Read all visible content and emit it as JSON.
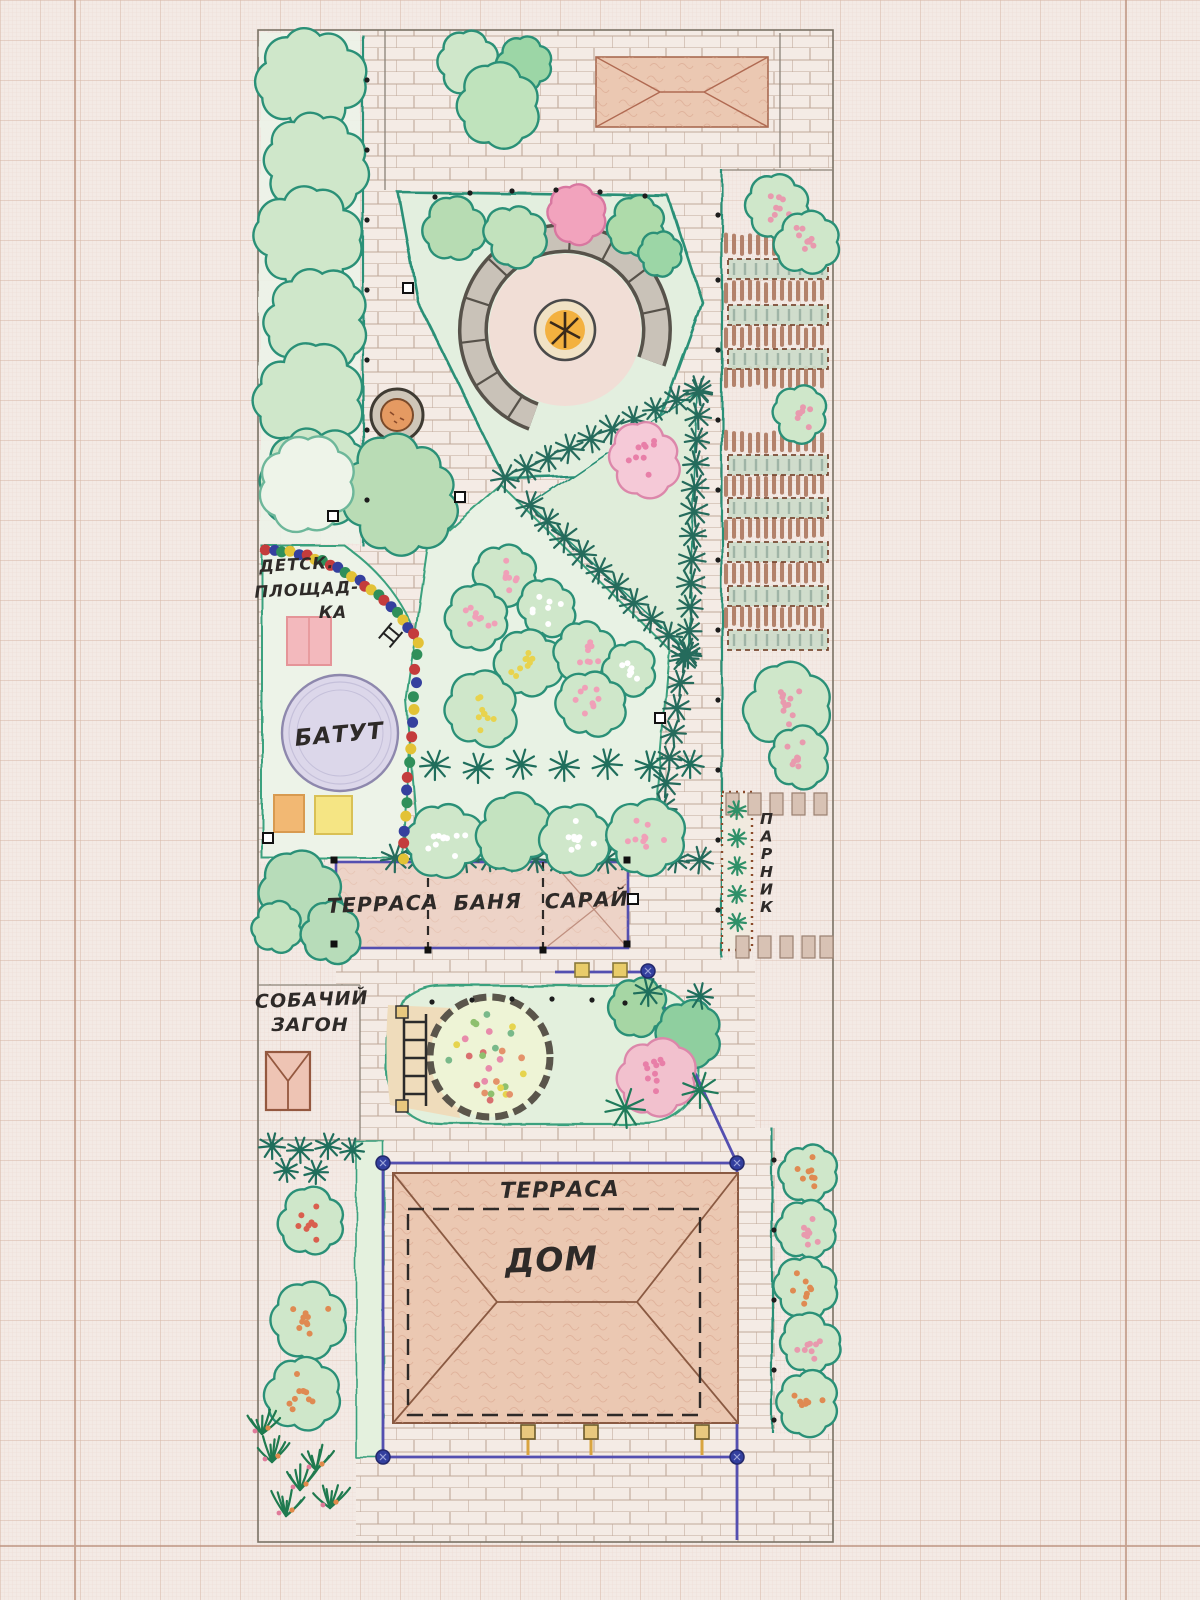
{
  "title": "Hand-drawn garden plot plan on millimeter graph paper",
  "labels": {
    "playground": [
      "ДЕТСК.",
      "ПЛОЩАД-",
      "КА"
    ],
    "trampoline": "БАТУТ",
    "terrace": "ТЕРРАСА",
    "banya": "БАНЯ",
    "shed": "САРАЙ",
    "dog_pen": [
      "СОБАЧИЙ",
      "ЗАГОН"
    ],
    "greenhouse": "ПАРНИК",
    "house_terrace": "ТЕРРАСА",
    "house": "ДОМ"
  },
  "colors": {
    "paper": "#f3eae5",
    "grid_fine": "#ecd8d1",
    "grid_major": "#d6b4a4",
    "brick_line": "#b69c8c",
    "pencil": "#8a8277",
    "teal": "#2a9077",
    "teal_dark": "#1f6e5c",
    "bed_green": "#e3efdf",
    "purple": "#544fb0",
    "ink": "#2e2a28",
    "roof": "#ebc8b2",
    "roof_line": "#a86a50",
    "building": "#edd3c7",
    "trampoline": "#dcd7ea",
    "sandbox_pink": "#f3b9bd",
    "box_orange": "#f2b873",
    "box_yellow": "#f5e584",
    "fire": "#f3b13f",
    "stone": "#c9c2b8",
    "tan": "#efdcbb",
    "navy_dot": "#333f9e"
  },
  "plan": {
    "bushes": [
      [
        312,
        80,
        50,
        null,
        null,
        null
      ],
      [
        316,
        160,
        48,
        null,
        null,
        null
      ],
      [
        308,
        240,
        50,
        null,
        null,
        null
      ],
      [
        314,
        320,
        48,
        null,
        null,
        null
      ],
      [
        306,
        400,
        50,
        null,
        null,
        null
      ],
      [
        314,
        478,
        48,
        null,
        null,
        null
      ],
      [
        470,
        62,
        30,
        null,
        null,
        null
      ],
      [
        526,
        64,
        26,
        "#9cd6a6",
        null,
        null
      ],
      [
        497,
        106,
        40,
        "#bfe3bc",
        null,
        null
      ],
      [
        457,
        230,
        30,
        "#b7dcb3",
        null,
        null
      ],
      [
        515,
        234,
        28,
        "#c2e2bd",
        null,
        null
      ],
      [
        576,
        215,
        26,
        "#f2a3bd",
        "#d877a0",
        null
      ],
      [
        637,
        226,
        28,
        "#aedbaa",
        null,
        null
      ],
      [
        662,
        254,
        20,
        "#9cd6a6",
        null,
        null
      ],
      [
        402,
        495,
        54,
        "#b9dcb5",
        null,
        null
      ],
      [
        308,
        482,
        44,
        "#eef4e9",
        "#6db79a",
        null
      ],
      [
        645,
        458,
        33,
        "#f5c9d7",
        "#dc87aa",
        "#e87fa8"
      ],
      [
        505,
        575,
        28,
        null,
        null,
        "#f0a0b8"
      ],
      [
        478,
        618,
        30,
        null,
        null,
        "#f0a0b8"
      ],
      [
        548,
        608,
        26,
        null,
        null,
        "#ffffff"
      ],
      [
        528,
        663,
        31,
        null,
        null,
        "#e8d34e"
      ],
      [
        585,
        650,
        28,
        null,
        null,
        "#f0a0b8"
      ],
      [
        630,
        668,
        24,
        null,
        null,
        "#ffffff"
      ],
      [
        482,
        710,
        33,
        null,
        null,
        "#e8d34e"
      ],
      [
        592,
        705,
        31,
        null,
        null,
        "#f0a0b8"
      ],
      [
        445,
        838,
        34,
        null,
        null,
        "#ffffff"
      ],
      [
        512,
        833,
        34,
        "#c4e3c0",
        null,
        null
      ],
      [
        578,
        840,
        32,
        null,
        null,
        "#ffffff"
      ],
      [
        645,
        838,
        34,
        null,
        null,
        "#f0a0b8"
      ],
      [
        300,
        895,
        38,
        "#b7dcb9",
        null,
        null
      ],
      [
        277,
        926,
        24,
        "#c4e3c0",
        null,
        null
      ],
      [
        332,
        932,
        28,
        "#b7dcb9",
        null,
        null
      ],
      [
        778,
        206,
        28,
        null,
        null,
        "#e89aae"
      ],
      [
        808,
        242,
        30,
        null,
        null,
        "#e89aae"
      ],
      [
        800,
        414,
        26,
        null,
        null,
        "#e89aae"
      ],
      [
        786,
        706,
        38,
        null,
        null,
        "#e89aae"
      ],
      [
        798,
        758,
        28,
        null,
        null,
        "#e89aae"
      ],
      [
        808,
        1172,
        27,
        null,
        null,
        "#df8a52"
      ],
      [
        808,
        1230,
        28,
        null,
        null,
        "#e89aae"
      ],
      [
        806,
        1287,
        28,
        null,
        null,
        "#df8a52"
      ],
      [
        809,
        1344,
        28,
        null,
        null,
        "#e89aae"
      ],
      [
        806,
        1402,
        29,
        null,
        null,
        "#df8a52"
      ],
      [
        312,
        1222,
        31,
        null,
        null,
        "#d95f4e"
      ],
      [
        310,
        1320,
        35,
        null,
        null,
        "#df8a52"
      ],
      [
        302,
        1392,
        35,
        null,
        null,
        "#df8a52"
      ],
      [
        640,
        1008,
        26,
        "#a6d6a4",
        null,
        null
      ],
      [
        688,
        1034,
        30,
        "#8fcf9f",
        null,
        null
      ],
      [
        655,
        1078,
        36,
        "#f2c1ce",
        "#dc87aa",
        "#e87fa8"
      ]
    ],
    "stars": [
      [
        435,
        765,
        15,
        null
      ],
      [
        478,
        768,
        15,
        null
      ],
      [
        521,
        764,
        15,
        null
      ],
      [
        564,
        766,
        15,
        null
      ],
      [
        607,
        764,
        15,
        null
      ],
      [
        650,
        766,
        15,
        null
      ],
      [
        690,
        764,
        14,
        null
      ],
      [
        272,
        1146,
        13,
        null
      ],
      [
        300,
        1150,
        13,
        null
      ],
      [
        328,
        1146,
        13,
        null
      ],
      [
        352,
        1150,
        12,
        null
      ],
      [
        286,
        1170,
        12,
        null
      ],
      [
        316,
        1172,
        12,
        null
      ],
      [
        625,
        1108,
        20,
        "#1f7a5a"
      ],
      [
        700,
        1090,
        18,
        "#1f7a5a"
      ],
      [
        648,
        992,
        14,
        null
      ],
      [
        700,
        996,
        13,
        null
      ],
      [
        737,
        810,
        9,
        "#2f9068"
      ],
      [
        737,
        838,
        9,
        "#2f9068"
      ],
      [
        737,
        866,
        9,
        "#2f9068"
      ],
      [
        737,
        894,
        9,
        "#2f9068"
      ],
      [
        737,
        922,
        9,
        "#2f9068"
      ]
    ],
    "conifer_chains": [
      [
        505,
        478,
        698,
        390
      ],
      [
        699,
        392,
        688,
        655
      ],
      [
        530,
        505,
        686,
        652
      ],
      [
        684,
        658,
        655,
        858
      ],
      [
        395,
        858,
        700,
        860
      ]
    ],
    "bead_colors": [
      "#c43c3c",
      "#35409e",
      "#2f8f5a",
      "#e3c236",
      "#35409e",
      "#c43c3c",
      "#e3c236",
      "#2f8f5a"
    ],
    "hatch_rows": [
      [
        726,
        236,
        102,
        17
      ],
      [
        726,
        283,
        102,
        17
      ],
      [
        726,
        328,
        102,
        17
      ],
      [
        726,
        368,
        102,
        17
      ],
      [
        726,
        433,
        102,
        17
      ],
      [
        726,
        477,
        102,
        17
      ],
      [
        726,
        520,
        102,
        17
      ],
      [
        726,
        564,
        102,
        17
      ],
      [
        726,
        608,
        102,
        17
      ]
    ],
    "veg_beds": [
      [
        728,
        259,
        100,
        20
      ],
      [
        728,
        305,
        100,
        20
      ],
      [
        728,
        349,
        100,
        20
      ],
      [
        728,
        455,
        100,
        20
      ],
      [
        728,
        498,
        100,
        20
      ],
      [
        728,
        542,
        100,
        20
      ],
      [
        728,
        586,
        100,
        20
      ],
      [
        728,
        630,
        100,
        20
      ]
    ],
    "blocks": [
      [
        726,
        793
      ],
      [
        748,
        793
      ],
      [
        770,
        793
      ],
      [
        792,
        793
      ],
      [
        814,
        793
      ],
      [
        736,
        936
      ],
      [
        758,
        936
      ],
      [
        780,
        936
      ],
      [
        802,
        936
      ],
      [
        820,
        936
      ]
    ],
    "black_dots": [
      [
        435,
        197
      ],
      [
        470,
        193
      ],
      [
        512,
        191
      ],
      [
        556,
        190
      ],
      [
        600,
        192
      ],
      [
        645,
        196
      ],
      [
        367,
        80
      ],
      [
        367,
        150
      ],
      [
        367,
        220
      ],
      [
        367,
        290
      ],
      [
        367,
        360
      ],
      [
        367,
        430
      ],
      [
        367,
        500
      ],
      [
        718,
        215
      ],
      [
        718,
        280
      ],
      [
        718,
        350
      ],
      [
        718,
        420
      ],
      [
        718,
        490
      ],
      [
        718,
        560
      ],
      [
        718,
        630
      ],
      [
        718,
        700
      ],
      [
        718,
        770
      ],
      [
        718,
        840
      ],
      [
        718,
        910
      ],
      [
        432,
        1002
      ],
      [
        472,
        1000
      ],
      [
        512,
        999
      ],
      [
        552,
        999
      ],
      [
        592,
        1000
      ],
      [
        625,
        1003
      ],
      [
        774,
        1160
      ],
      [
        774,
        1230
      ],
      [
        774,
        1300
      ],
      [
        774,
        1370
      ],
      [
        774,
        1420
      ]
    ],
    "open_squares": [
      [
        333,
        516
      ],
      [
        408,
        288
      ],
      [
        460,
        497
      ],
      [
        660,
        718
      ],
      [
        268,
        838
      ],
      [
        633,
        899
      ]
    ],
    "corner_squares": [
      [
        334,
        860
      ],
      [
        627,
        860
      ],
      [
        334,
        944
      ],
      [
        627,
        944
      ],
      [
        428,
        950
      ],
      [
        543,
        950
      ]
    ],
    "blue_dots": [
      [
        383,
        1163
      ],
      [
        737,
        1163
      ],
      [
        383,
        1457
      ],
      [
        737,
        1457
      ],
      [
        648,
        971
      ]
    ],
    "roof_posts": [
      [
        521,
        1425
      ],
      [
        584,
        1425
      ],
      [
        695,
        1425
      ]
    ],
    "fence_posts": [
      [
        575,
        963
      ],
      [
        613,
        963
      ]
    ],
    "grass": [
      [
        272,
        1462
      ],
      [
        300,
        1490
      ],
      [
        330,
        1508
      ],
      [
        286,
        1516
      ],
      [
        262,
        1434
      ],
      [
        316,
        1470
      ]
    ],
    "flower_circle": {
      "c": [
        490,
        1057
      ],
      "r": 46,
      "n": 28,
      "colors": [
        "#e88bab",
        "#e6d44e",
        "#8ec06e",
        "#e4926a",
        "#79b98a",
        "#d96f6f"
      ]
    },
    "bench": {
      "c": [
        565,
        330
      ],
      "r1": 80,
      "r2": 105,
      "a1": 115,
      "a2": 375,
      "step": 25
    }
  }
}
